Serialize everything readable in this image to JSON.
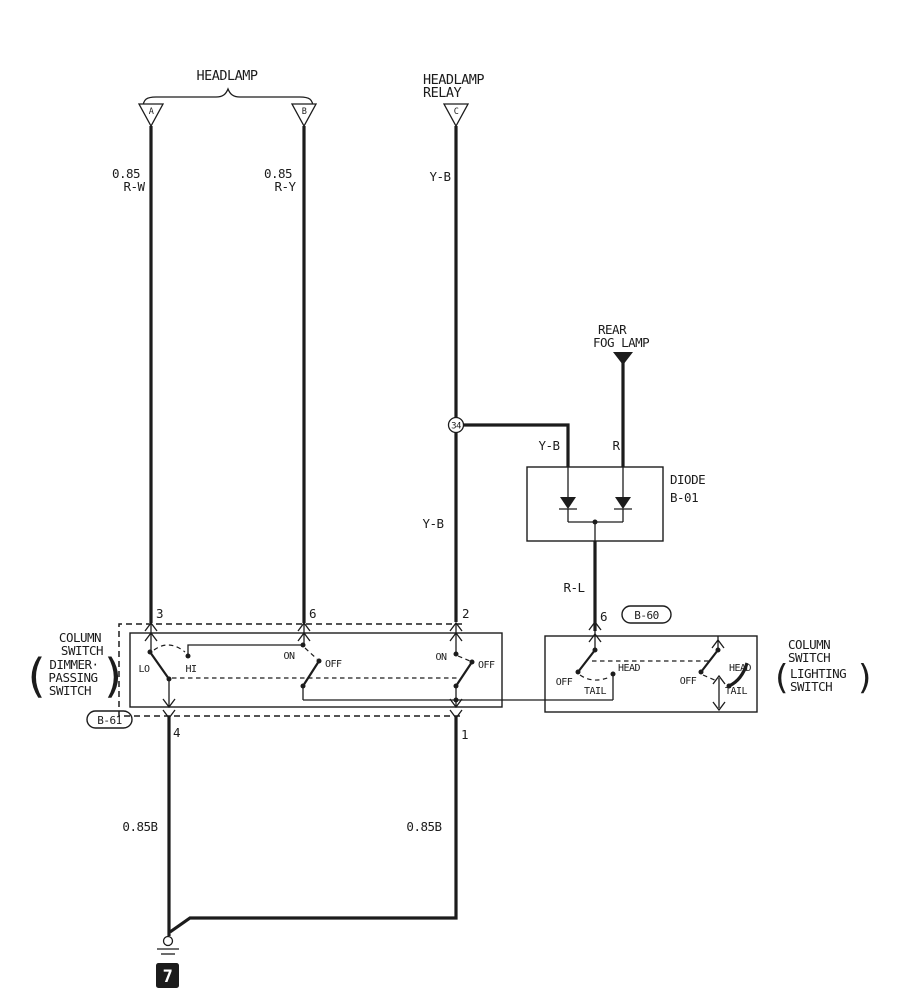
{
  "colors": {
    "ink": "#1c1c1c",
    "paper": "#ffffff"
  },
  "header": {
    "headlamp_label": "HEADLAMP",
    "relay_label_line1": "HEADLAMP",
    "relay_label_line2": "RELAY",
    "connector_a": "A",
    "connector_b": "B",
    "connector_c": "C"
  },
  "wires": {
    "a_gauge": "0.85",
    "a_color": "R-W",
    "b_gauge": "0.85",
    "b_color": "R-Y",
    "c_color_top": "Y-B",
    "c_color_mid": "Y-B",
    "branch_color": "Y-B",
    "fog_color": "R",
    "diode_out_color": "R-L",
    "ground_left_gauge": "0.85B",
    "ground_right_gauge": "0.85B"
  },
  "rear_fog_lamp": {
    "line1": "REAR",
    "line2": "FOG LAMP"
  },
  "splice_node": "34",
  "diode": {
    "name": "DIODE",
    "ref": "B-01"
  },
  "b60_connector": {
    "pin": "6",
    "ref": "B-60"
  },
  "dimmer_switch": {
    "name_line1": "COLUMN",
    "name_line2": "SWITCH",
    "sub_line1": "DIMMER·",
    "sub_line2": "PASSING",
    "sub_line3": "SWITCH",
    "paren_open": "(",
    "paren_close": ")",
    "ref": "B-61",
    "pin3": "3",
    "pin6": "6",
    "pin2": "2",
    "pin4": "4",
    "pin1": "1",
    "lo": "LO",
    "hi": "HI",
    "on1": "ON",
    "off1": "OFF",
    "on2": "ON",
    "off2": "OFF"
  },
  "lighting_switch": {
    "name_line1": "COLUMN",
    "name_line2": "SWITCH",
    "sub_line1": "LIGHTING",
    "sub_line2": "SWITCH",
    "paren_open": "(",
    "paren_close": ")",
    "off1": "OFF",
    "tail1": "TAIL",
    "head1": "HEAD",
    "off2": "OFF",
    "head2": "HEAD",
    "tail2": "TAIL"
  },
  "ground": {
    "badge": "7"
  }
}
